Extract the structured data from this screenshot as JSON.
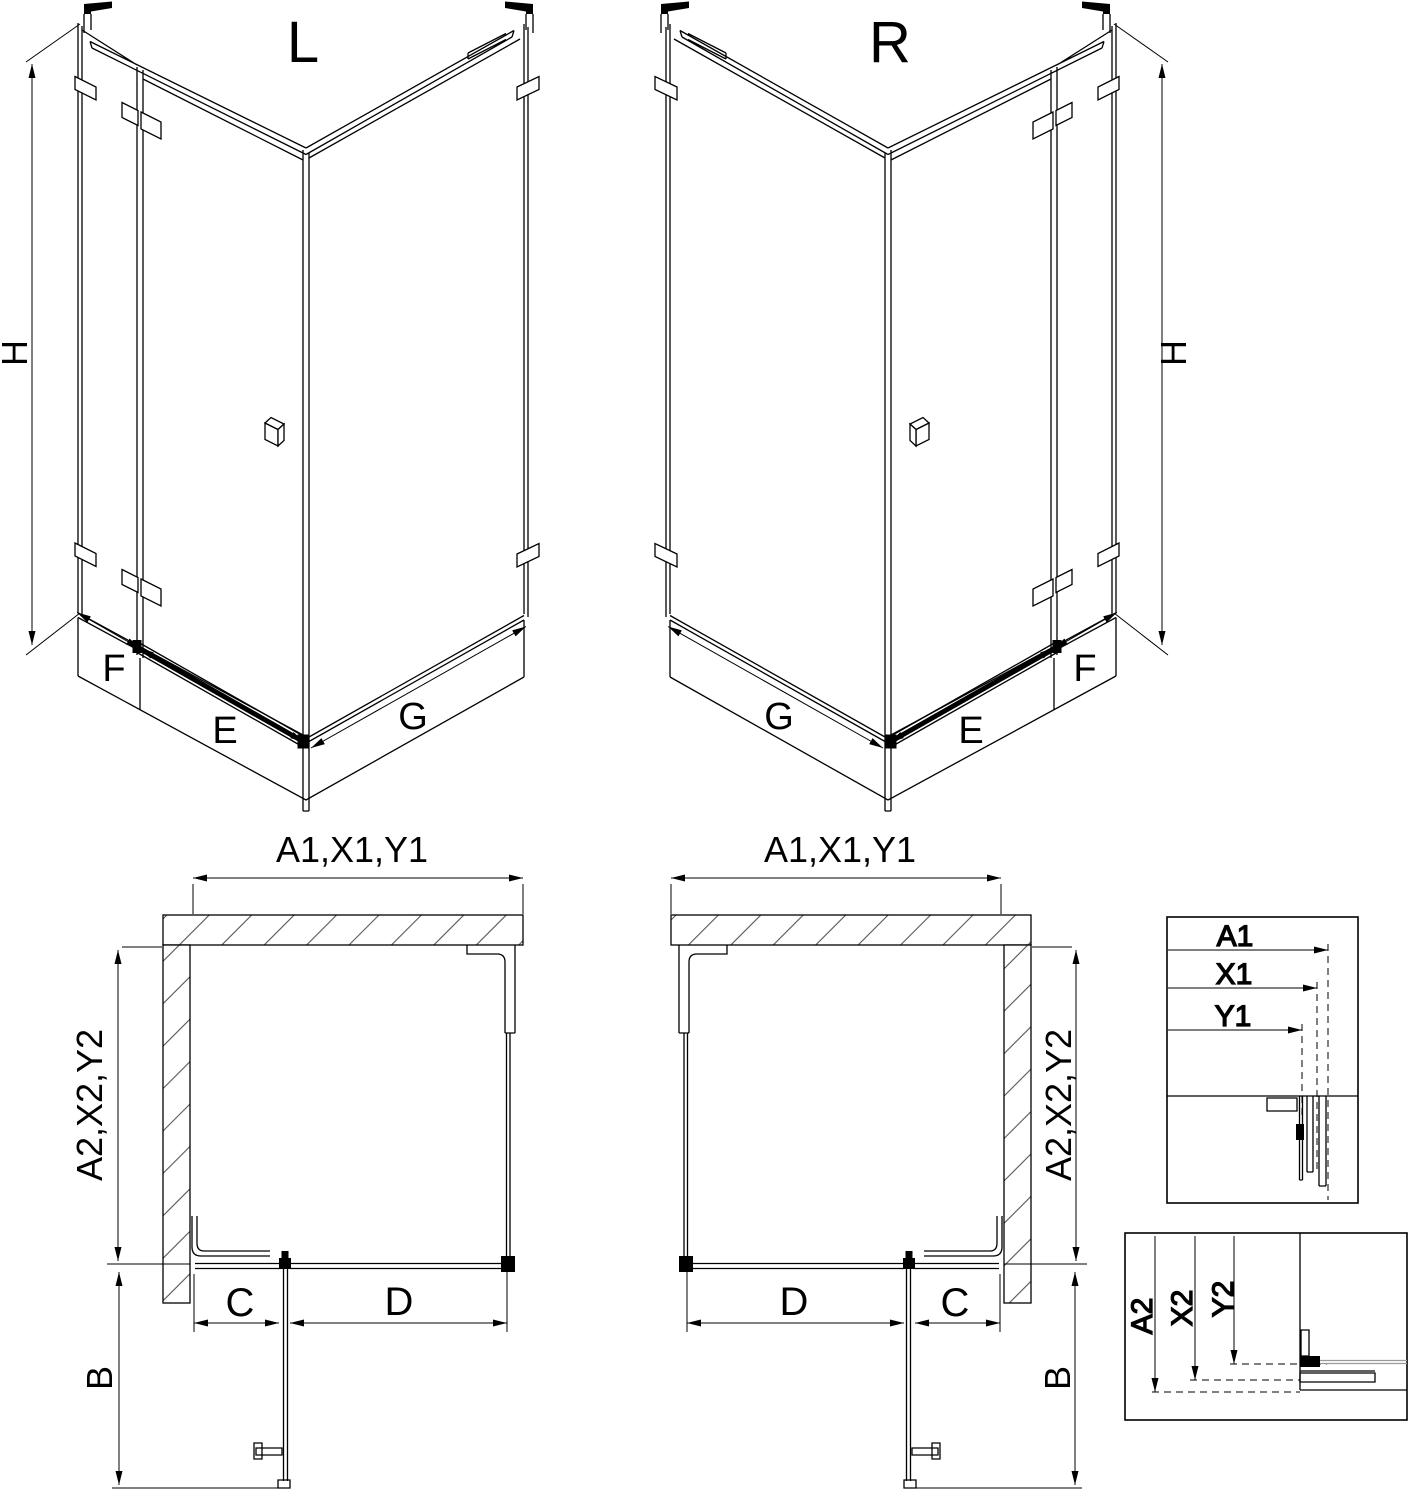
{
  "drawing": {
    "background": "#ffffff",
    "line_color": "#000000",
    "glass_section_gray": "#9a9a9a"
  },
  "iso_left": {
    "title": "L",
    "height_label": "H",
    "fixed_side_label": "F",
    "door_label": "E",
    "side_panel_label": "G"
  },
  "iso_right": {
    "title": "R",
    "height_label": "H",
    "fixed_side_label": "F",
    "door_label": "E",
    "side_panel_label": "G"
  },
  "plan_left": {
    "width_dim": "A1,X1,Y1",
    "depth_dim": "A2,X2,Y2",
    "door_opening_dim": "C",
    "front_panel_dim": "D",
    "door_swing_dim": "B"
  },
  "plan_right": {
    "width_dim": "A1,X1,Y1",
    "depth_dim": "A2,X2,Y2",
    "door_opening_dim": "C",
    "front_panel_dim": "D",
    "door_swing_dim": "B"
  },
  "detail_width": {
    "dims": [
      "A1",
      "X1",
      "Y1"
    ]
  },
  "detail_depth": {
    "dims": [
      "A2",
      "X2",
      "Y2"
    ]
  }
}
